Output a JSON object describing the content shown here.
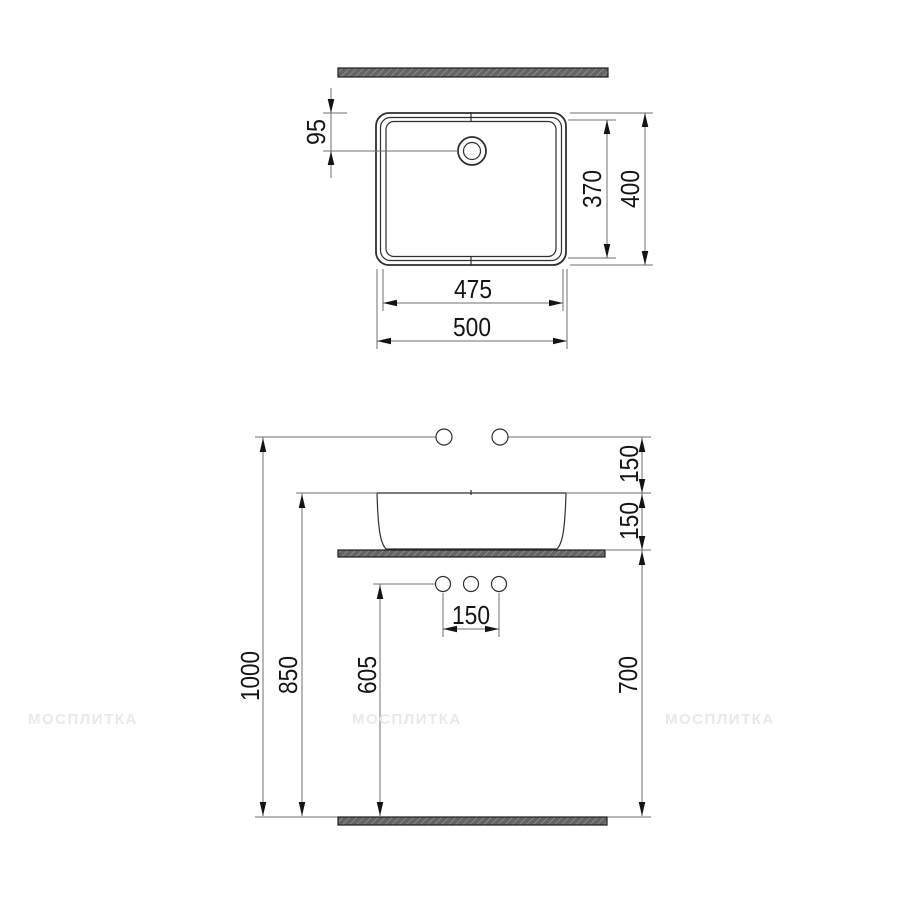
{
  "drawing": {
    "watermark": "МОСПЛИТКА",
    "top_view": {
      "dim_faucet_offset": "95",
      "dim_inner_depth": "370",
      "dim_outer_depth": "400",
      "dim_inner_width": "475",
      "dim_outer_width": "500"
    },
    "front_view": {
      "dim_faucet_above_rim": "150",
      "dim_basin_height": "150",
      "dim_hole_spacing": "150",
      "dim_outlet_height": "605",
      "dim_counter_height": "700",
      "dim_rim_height": "850",
      "dim_faucet_height": "1000"
    }
  }
}
